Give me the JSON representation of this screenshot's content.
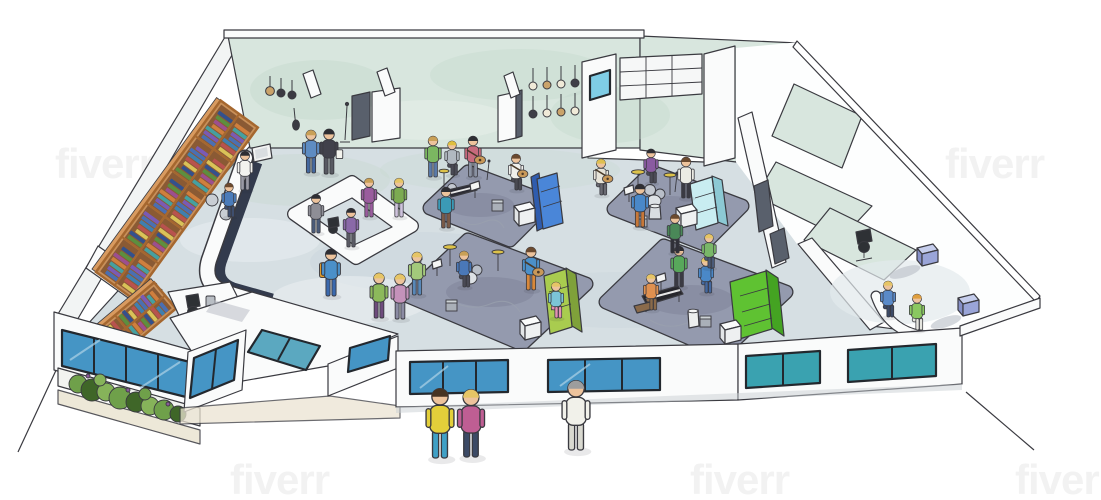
{
  "watermark": {
    "text": "fiverr"
  },
  "palette": {
    "paper": "#ffffff",
    "ink": "#3a3a40",
    "wallMint": "#d8e6de",
    "wallMintDeep": "#c3d8cb",
    "floor": "#d6dfe3",
    "floorShade": "#bfccd6",
    "floorLight": "#eef2f4",
    "wing": "#fdfefe",
    "rug": "#949aae",
    "rugDeep": "#7d8298",
    "white": "#fafbfb",
    "wood": "#c8905a",
    "woodDark": "#a5672f",
    "woodTop": "#d89a5f",
    "cubby": "#8a5a34",
    "counterDark": "#333b4d",
    "windowBlue": "#4595c5",
    "windowTeal": "#3aa2b0",
    "windowStreak": "#a8cfe4",
    "frame": "#23282e",
    "cyanPane": "#7fcde6",
    "sofaBlue": "#4a86d8",
    "sofaBlueDark": "#2f5cae",
    "sofaCyan": "#c9edf1",
    "sofaCyanDark": "#8cc9d4",
    "sofaGreen": "#a9cc4f",
    "sofaGreenDark": "#7fa13a",
    "sofaLime": "#5fc232",
    "sofaLimeDark": "#44a322",
    "cubeTopBlue": "#c5cdec",
    "cubeSideBlue": "#9aa5d8",
    "cubeFrontBlue": "#8690c8",
    "plantLight": "#86b35a",
    "plantMid": "#6fa04a",
    "plantDark": "#3f6628",
    "groundTan": "#ebe4d2",
    "metal": "#b9bec4",
    "cymbal": "#dcc24a",
    "drum": "#c3c8d0",
    "skin": "#edc39c",
    "doorDark": "#59606c",
    "chairDark": "#2e3135"
  },
  "scene": {
    "bookColors": [
      "#4a6fb3",
      "#7a5ab5",
      "#45a0a0",
      "#cf7f3e",
      "#9c4f8f",
      "#5c8f3f",
      "#33518d",
      "#d9c258",
      "#b8524e",
      "#3f7fb0"
    ],
    "people": [
      {
        "x": 440,
        "y": 458,
        "s": 1.7,
        "pose": "stand",
        "shirt": "#e3cf3a",
        "pants": "#3fa0c6",
        "hair": "#463322"
      },
      {
        "x": 471,
        "y": 457,
        "s": 1.65,
        "pose": "stand",
        "shirt": "#bf5e93",
        "pants": "#3c4a66",
        "hair": "#e6c566"
      },
      {
        "x": 576,
        "y": 450,
        "s": 1.7,
        "pose": "stand",
        "shirt": "#f1f1ea",
        "pants": "#d9d9d0",
        "hair": "#9d9d9d"
      },
      {
        "x": 311,
        "y": 173,
        "s": 1.05,
        "pose": "stand",
        "shirt": "#5e8cc2",
        "pants": "#44689f",
        "hair": "#c9a057"
      },
      {
        "x": 329,
        "y": 174,
        "s": 1.1,
        "pose": "stand",
        "shirt": "#41414b",
        "pants": "#585962",
        "hair": "#2e2e33",
        "acc": {
          "type": "bag",
          "color": "#f4f4ee"
        }
      },
      {
        "x": 369,
        "y": 217,
        "s": 0.95,
        "pose": "stand",
        "shirt": "#9a5c9d",
        "pants": "#9a5c9d",
        "hair": "#c9a057"
      },
      {
        "x": 399,
        "y": 217,
        "s": 0.95,
        "pose": "stand",
        "shirt": "#7cab51",
        "pants": "#cfc3dd",
        "hair": "#e6c566"
      },
      {
        "x": 316,
        "y": 233,
        "s": 0.95,
        "pose": "stand",
        "shirt": "#8e8e96",
        "pants": "#4b5c7a",
        "hair": "#2e2e33"
      },
      {
        "x": 351,
        "y": 247,
        "s": 0.95,
        "pose": "stand",
        "shirt": "#8a69a8",
        "pants": "#5a5a64",
        "hair": "#2e2e33"
      },
      {
        "x": 331,
        "y": 296,
        "s": 1.15,
        "pose": "stand",
        "shirt": "#4b90c9",
        "pants": "#3a69ae",
        "hair": "#2e2e33",
        "acc": {
          "type": "backpack",
          "color": "#dd9a2c"
        }
      },
      {
        "x": 379,
        "y": 318,
        "s": 1.1,
        "pose": "stand",
        "shirt": "#8cb95b",
        "pants": "#6e4b7d",
        "hair": "#e6c566"
      },
      {
        "x": 400,
        "y": 319,
        "s": 1.1,
        "pose": "stand",
        "shirt": "#c492ba",
        "pants": "#8b8ba3",
        "hair": "#e6c566"
      },
      {
        "x": 245,
        "y": 190,
        "s": 0.95,
        "pose": "stand",
        "shirt": "#f3f3ef",
        "pants": "#9a9aa4",
        "hair": "#2e2e33"
      },
      {
        "x": 229,
        "y": 217,
        "s": 0.9,
        "pose": "sit",
        "shirt": "#4b7cba",
        "pants": "#3e4e6e",
        "hair": "#6b4a2f"
      },
      {
        "x": 433,
        "y": 177,
        "s": 1.0,
        "pose": "stand",
        "shirt": "#7bb761",
        "pants": "#5a7aa8",
        "hair": "#c9a057"
      },
      {
        "x": 452,
        "y": 175,
        "s": 0.9,
        "pose": "sit",
        "shirt": "#b1b9c1",
        "pants": "#4a4a55",
        "hair": "#dfbf3f"
      },
      {
        "x": 473,
        "y": 177,
        "s": 1.0,
        "pose": "stand",
        "shirt": "#c66a7c",
        "pants": "#8a92a2",
        "hair": "#2e2e33",
        "acc": {
          "type": "guitar",
          "color": "#c89858"
        }
      },
      {
        "x": 516,
        "y": 190,
        "s": 0.95,
        "pose": "sit",
        "shirt": "#efefeb",
        "pants": "#4a4a52",
        "hair": "#6b4a2f",
        "acc": {
          "type": "guitar",
          "color": "#c89858"
        }
      },
      {
        "x": 446,
        "y": 228,
        "s": 1.0,
        "pose": "stand",
        "shirt": "#3b9ab6",
        "pants": "#7a5a47",
        "hair": "#2e2e33"
      },
      {
        "x": 601,
        "y": 195,
        "s": 0.95,
        "pose": "sit",
        "shirt": "#e7e3d8",
        "pants": "#6a6a72",
        "hair": "#dfc050",
        "acc": {
          "type": "guitar",
          "color": "#c89858"
        }
      },
      {
        "x": 651,
        "y": 183,
        "s": 0.9,
        "pose": "sit",
        "shirt": "#8a5ba1",
        "pants": "#4a4a55",
        "hair": "#2e2e33"
      },
      {
        "x": 686,
        "y": 198,
        "s": 1.0,
        "pose": "stand",
        "shirt": "#ebebe4",
        "pants": "#3a3a43",
        "hair": "#6b4a2f"
      },
      {
        "x": 640,
        "y": 227,
        "s": 1.05,
        "pose": "stand",
        "shirt": "#4a88c8",
        "pants": "#c87838",
        "hair": "#2e2e33"
      },
      {
        "x": 417,
        "y": 295,
        "s": 1.05,
        "pose": "stand",
        "shirt": "#a3c97b",
        "pants": "#5888b8",
        "hair": "#e6c566"
      },
      {
        "x": 464,
        "y": 287,
        "s": 0.95,
        "pose": "sit",
        "shirt": "#4a78b8",
        "pants": "#4a4a55",
        "hair": "#c9a057"
      },
      {
        "x": 531,
        "y": 290,
        "s": 1.05,
        "pose": "stand",
        "shirt": "#4b90c9",
        "pants": "#d8883a",
        "hair": "#6b4a2f",
        "acc": {
          "type": "guitar",
          "color": "#c89858"
        }
      },
      {
        "x": 556,
        "y": 318,
        "s": 0.95,
        "pose": "sit",
        "shirt": "#7cc4d6",
        "pants": "#e391b2",
        "hair": "#e6c566"
      },
      {
        "x": 651,
        "y": 310,
        "s": 0.95,
        "pose": "sit",
        "shirt": "#df9050",
        "pants": "#8a6a4a",
        "hair": "#e6c566"
      },
      {
        "x": 679,
        "y": 287,
        "s": 1.0,
        "pose": "stand",
        "shirt": "#58a85b",
        "pants": "#3a3a43",
        "hair": "#2e2e33"
      },
      {
        "x": 706,
        "y": 293,
        "s": 0.95,
        "pose": "sit",
        "shirt": "#4a88c8",
        "pants": "#44689f",
        "hair": "#e6c566"
      },
      {
        "x": 709,
        "y": 268,
        "s": 0.9,
        "pose": "sit",
        "shirt": "#79b768",
        "pants": "#4a5a78",
        "hair": "#e6c566"
      },
      {
        "x": 675,
        "y": 253,
        "s": 0.95,
        "pose": "stand",
        "shirt": "#4a8858",
        "pants": "#2f2f38",
        "hair": "#6b4a2f"
      },
      {
        "x": 888,
        "y": 317,
        "s": 0.95,
        "pose": "sit",
        "shirt": "#5a8ac8",
        "pants": "#3c4a66",
        "hair": "#e6c566"
      },
      {
        "x": 917,
        "y": 330,
        "s": 0.95,
        "pose": "sit",
        "shirt": "#8ac860",
        "pants": "#e6e6e0",
        "hair": "#df9f3f"
      }
    ]
  }
}
